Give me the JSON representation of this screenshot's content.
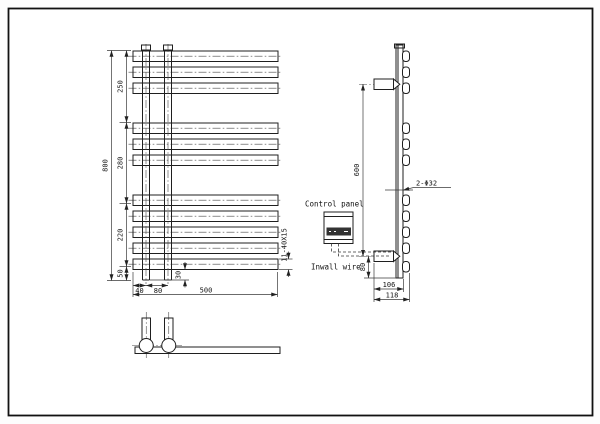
{
  "drawing": {
    "front_view": {
      "overall_height": "800",
      "segments": [
        "250",
        "280",
        "220",
        "50"
      ],
      "overall_width": "500",
      "left_offset": "40",
      "pipe_spacing": "80",
      "bottom_gap": "30",
      "bar_spec": "11-40X15"
    },
    "side_view": {
      "bracket_spacing": "600",
      "hole_spec": "2-Φ32",
      "control_panel_label": "Control panel",
      "inwall_wire_label": "Inwall wire",
      "wire_height": "80",
      "depth_inner": "106",
      "depth_overall": "118"
    },
    "colors": {
      "line": "#1f1f1f",
      "background": "#ffffff",
      "panel_display": "#333333"
    }
  }
}
